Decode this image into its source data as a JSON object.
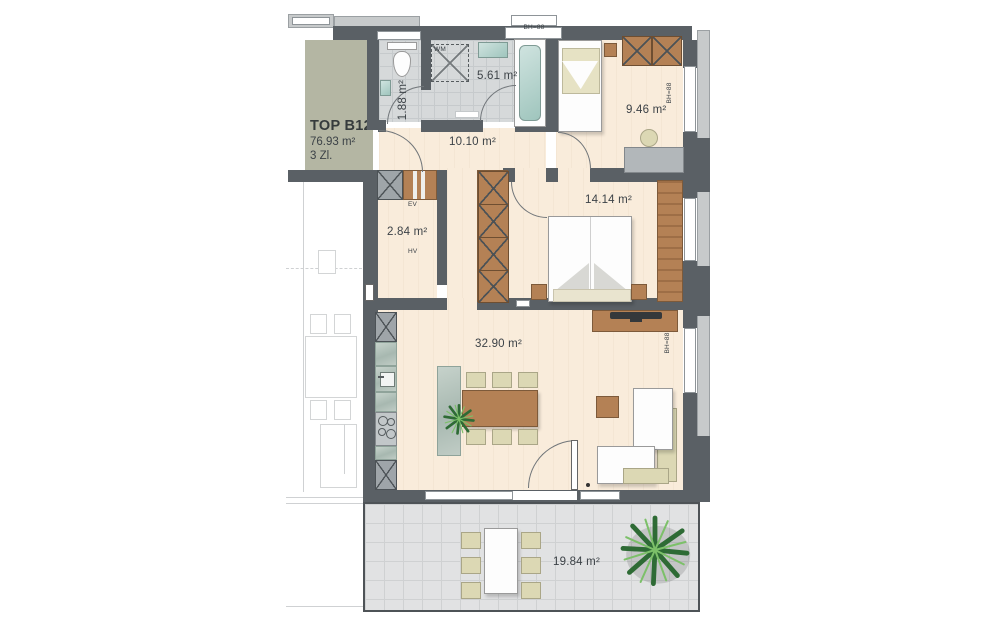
{
  "plan": {
    "title_block": {
      "unit": "TOP B12",
      "total_area": "76.93 m²",
      "room_count": "3 Zl."
    },
    "rooms": {
      "wc": {
        "area": "1.88 m²"
      },
      "bathroom": {
        "area": "5.61 m²"
      },
      "hallway": {
        "area": "10.10 m²"
      },
      "bedroom_small": {
        "area": "9.46 m²"
      },
      "bedroom_large": {
        "area": "14.14 m²"
      },
      "storage": {
        "area": "2.84 m²"
      },
      "living_kitchen": {
        "area": "32.90 m²"
      },
      "terrace": {
        "area": "19.84 m²"
      }
    },
    "annotations": {
      "window_sill_height": "BH=88",
      "washing_machine": "WM",
      "electrical_dist": "EV",
      "main_dist": "HV"
    },
    "colors": {
      "wall": "#5a6065",
      "floor": "#f9ecdb",
      "wet_room_tile": "#d6d9da",
      "terrace_tile": "#e1e2e3",
      "wood": "#b48155",
      "label_area_bg": "#b4b6a3",
      "upholstery": "#dcd8b4",
      "plant": "#2e6b35"
    }
  }
}
